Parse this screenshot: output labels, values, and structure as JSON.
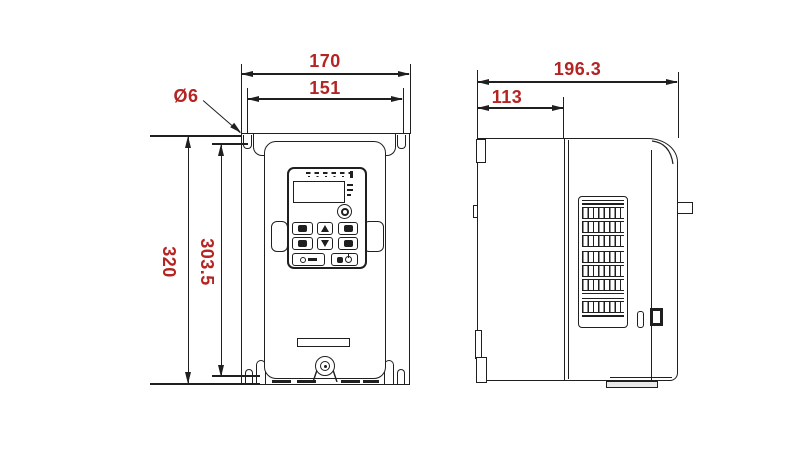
{
  "drawing": {
    "type": "technical-dimension-drawing",
    "subject": "frequency-inverter-enclosure",
    "colors": {
      "dimension_text": "#b42423",
      "line": "#1f1f1f",
      "background": "#ffffff"
    },
    "views": {
      "front": {
        "label": "front-view",
        "dimensions": {
          "overall_width": "170",
          "hole_spacing_width": "151",
          "hole_diameter": "Ø6",
          "overall_height": "320",
          "hole_spacing_height": "303.5"
        }
      },
      "side": {
        "label": "side-view",
        "dimensions": {
          "overall_depth": "196.3",
          "front_depth": "113"
        }
      }
    }
  }
}
